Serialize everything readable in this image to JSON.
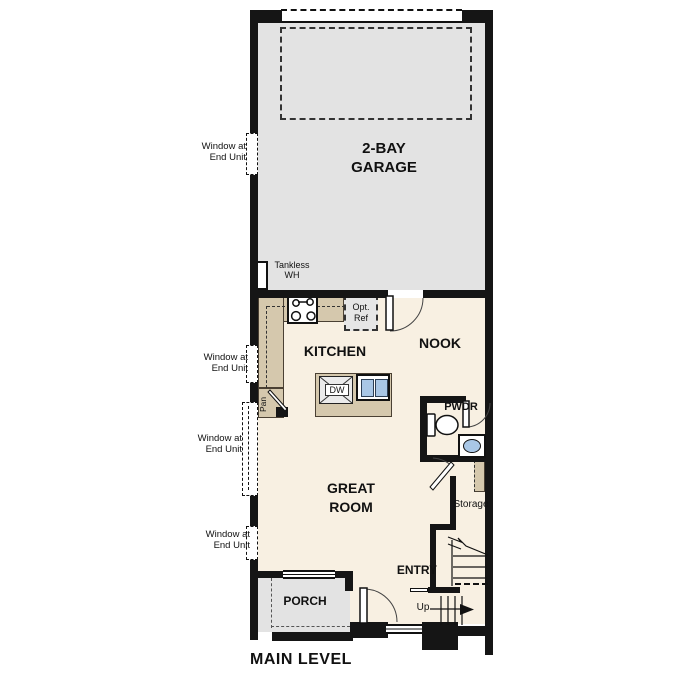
{
  "plan": {
    "title": "MAIN LEVEL",
    "rooms": {
      "garage": "2-BAY\nGARAGE",
      "kitchen": "KITCHEN",
      "nook": "NOOK",
      "great_room": "GREAT\nROOM",
      "powder": "PWDR",
      "entry": "ENTRY",
      "porch": "PORCH",
      "storage": "Storage",
      "pantry": "Pan"
    },
    "annotations": {
      "tankless_wh": "Tankless\nWH",
      "opt_ref": "Opt.\nRef",
      "dishwasher": "DW",
      "stairs_up": "Up",
      "window_note": "Window at\nEnd Unit"
    },
    "colors": {
      "wall": "#151515",
      "garage_floor": "#e3e3e3",
      "living_floor": "#f8f0e2",
      "counter": "#d5c8ad",
      "porch_floor": "#e3e3e3",
      "fixture_blue": "#a9c7e6"
    }
  }
}
